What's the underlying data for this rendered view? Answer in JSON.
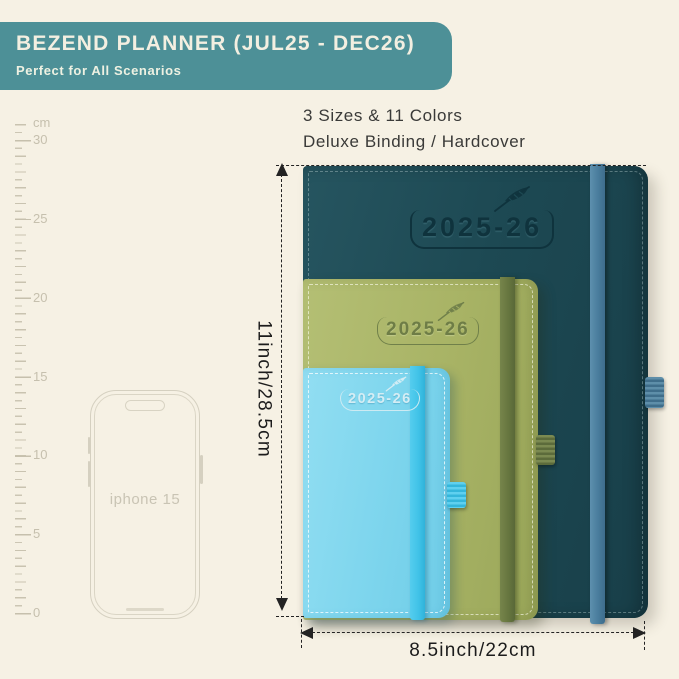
{
  "header": {
    "title": "BEZEND PLANNER (JUL25 - DEC26)",
    "subtitle": "Perfect for All Scenarios"
  },
  "features": {
    "line1": "3 Sizes & 11 Colors",
    "line2": "Deluxe Binding / Hardcover"
  },
  "ruler": {
    "unit": "cm",
    "marks": [
      "30",
      "25",
      "20",
      "15",
      "10",
      "5",
      "0"
    ]
  },
  "phone": {
    "label": "iphone 15"
  },
  "planners": {
    "large": {
      "year": "2025-26",
      "cover_color": "#1d4953",
      "band_color": "#497c9c"
    },
    "medium": {
      "year": "2025-26",
      "cover_color": "#a8b365",
      "band_color": "#67763f"
    },
    "small": {
      "year": "2025-26",
      "cover_color": "#7dd5ed",
      "band_color": "#41c3e8"
    }
  },
  "dimensions": {
    "height": "11inch/28.5cm",
    "width": "8.5inch/22cm"
  },
  "colors": {
    "background": "#f6f1e4",
    "banner": "#4d9097",
    "banner_text": "#f3efe1",
    "annotation": "#232323",
    "ruler_gray": "#c9c3b0"
  }
}
